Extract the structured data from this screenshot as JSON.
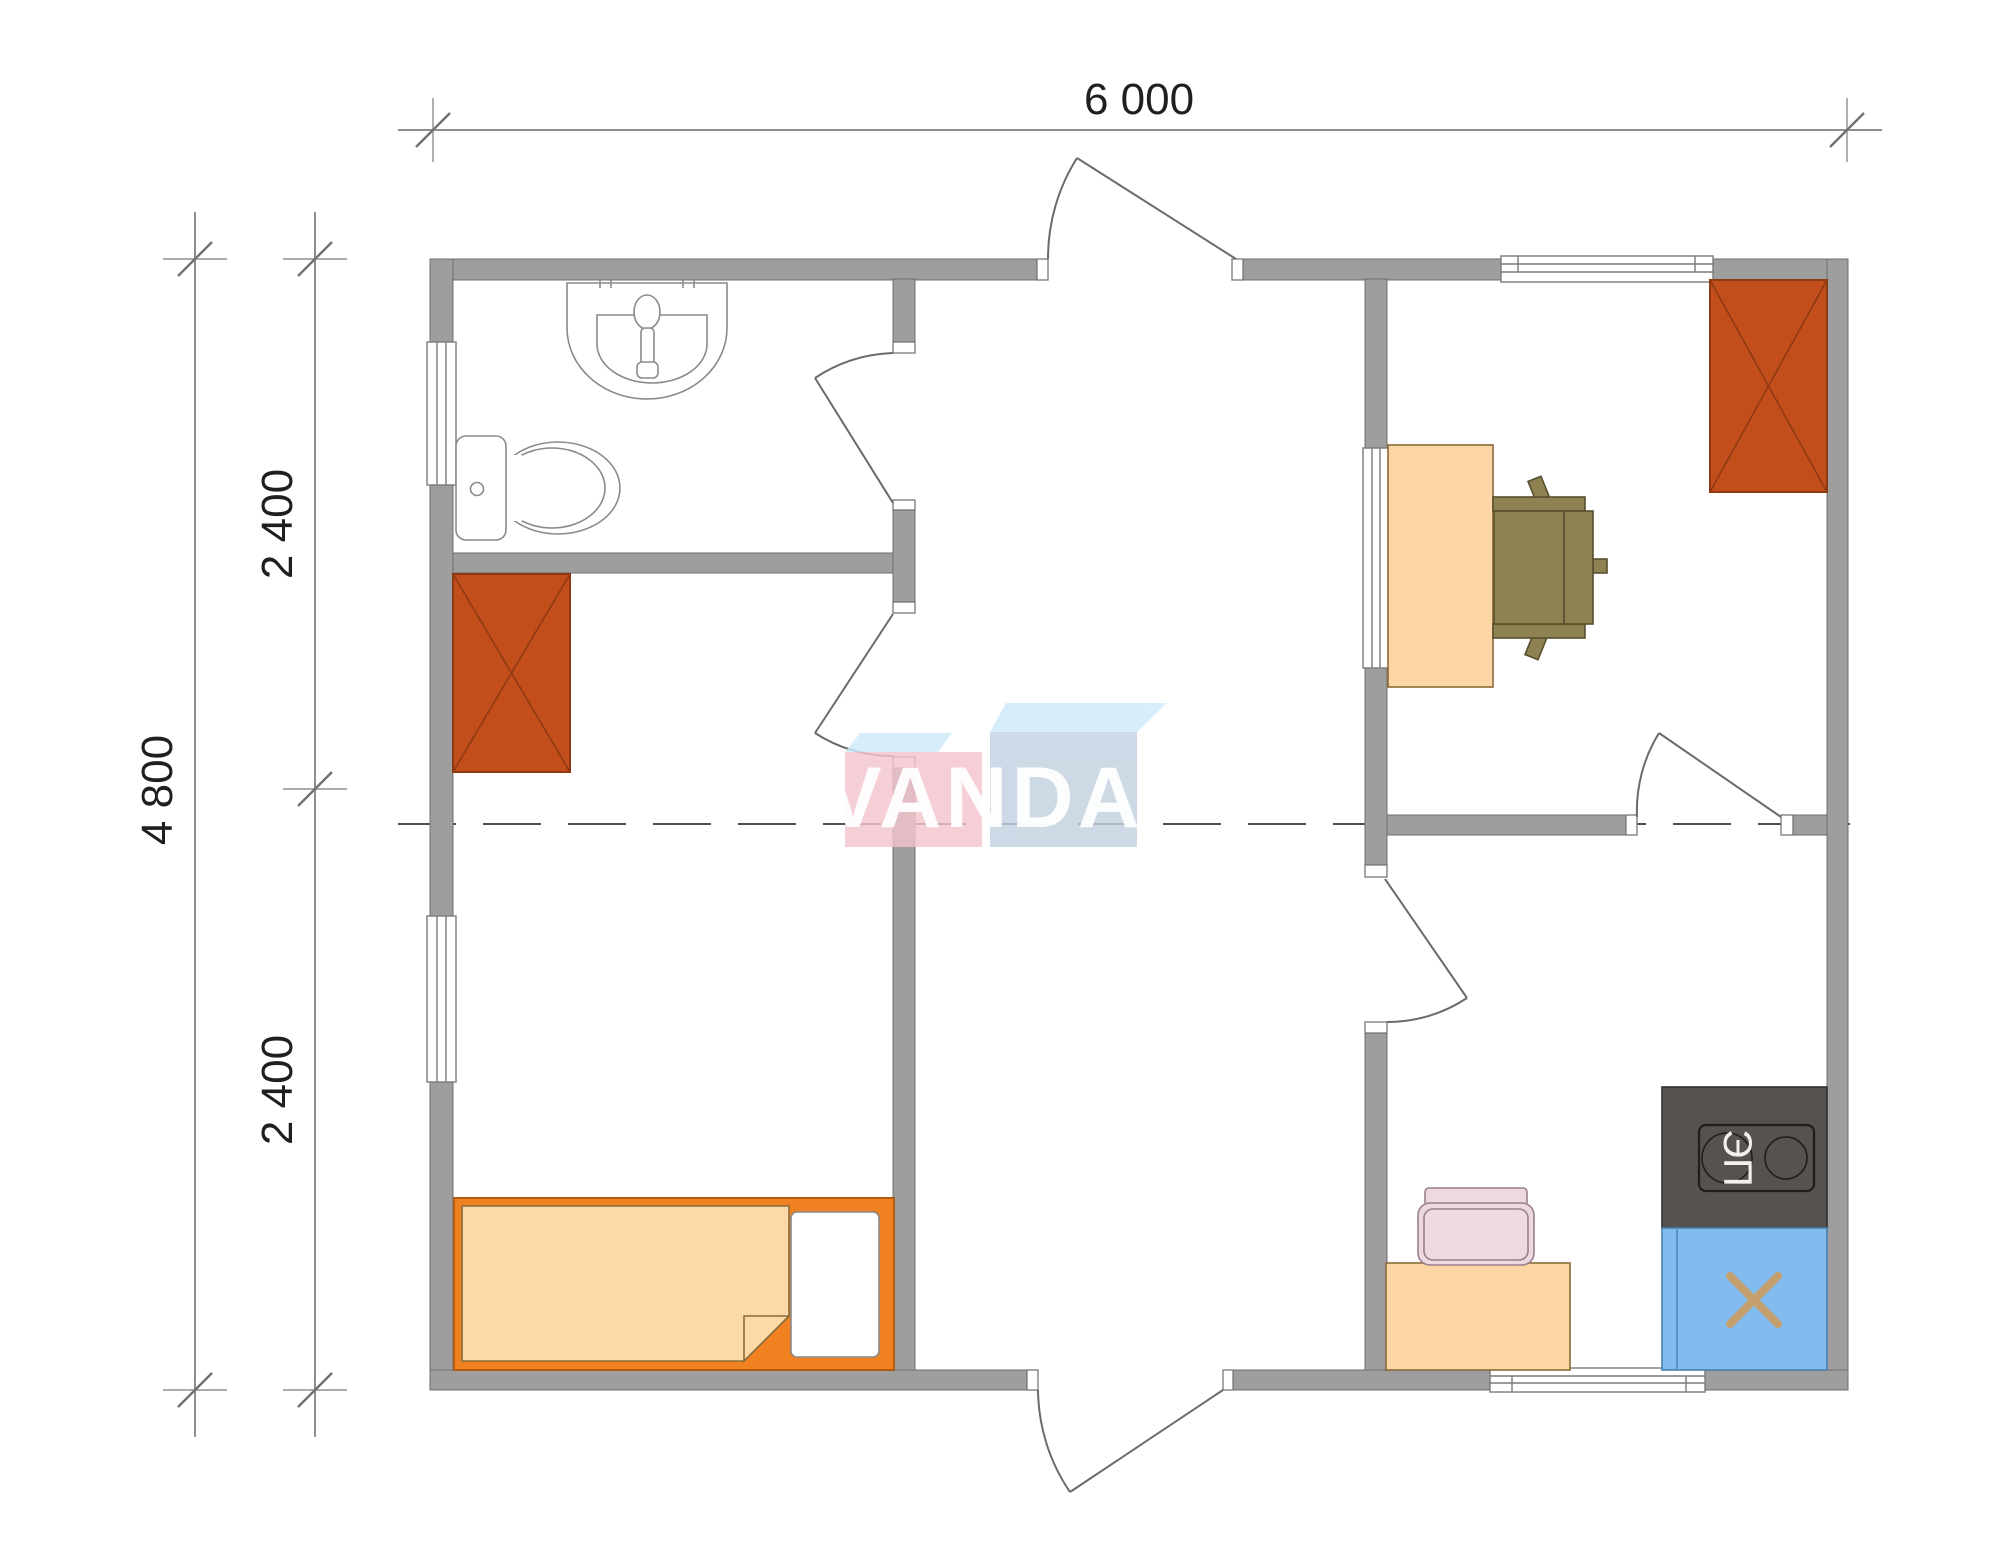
{
  "drawing": {
    "type": "floor-plan",
    "dimensions": {
      "top": "6 000",
      "left_total": "4 800",
      "left_upper": "2 400",
      "left_lower": "2 400"
    },
    "watermark": {
      "text": "VANDA"
    },
    "stove": {
      "label": "ЭП"
    },
    "furniture_symbols": [
      "bathroom-sink",
      "toilet",
      "wardrobe",
      "bed",
      "pillow",
      "desk",
      "office-chair",
      "electric-stove",
      "kitchen-sink",
      "kitchen-table",
      "chair"
    ],
    "colors": {
      "wall": "#9e9e9e",
      "wall_edge": "#6f6f6f",
      "door_line": "#6b6b6b",
      "sanitary_line": "#8a8a8a",
      "wardrobe": "#c14e1b",
      "wardrobe_line": "#8f3a12",
      "bed_frame": "#f08121",
      "mattress": "#fdd9a8",
      "pillow": "#ffffff",
      "peach": "#fcd6a4",
      "chair_olive": "#8e8152",
      "stove_dark": "#57524d",
      "sink_blue": "#82bcee",
      "sink_x": "#c5a06c",
      "chair_pink": "#eddade",
      "logo_pink": "#f3c5cd",
      "logo_blue": "#c3d1e1",
      "logo_bevel": "#cfeafa",
      "dash_line": "#4f4f4f",
      "dim_line": "#8f8f8f",
      "dim_text": "#1f1f1f"
    }
  }
}
